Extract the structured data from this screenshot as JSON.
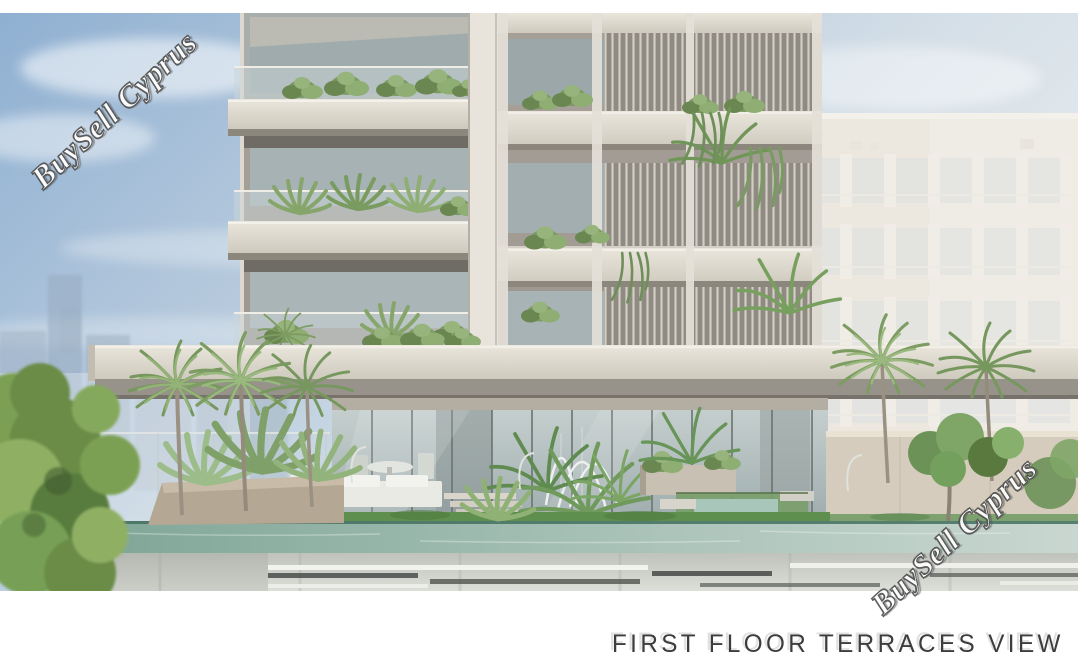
{
  "render": {
    "caption": "FIRST FLOOR TERRACES VIEW",
    "watermarks": [
      {
        "text": "BuySell Cyprus",
        "position": "top-left"
      },
      {
        "text": "BuySell Cyprus",
        "position": "bottom-right"
      }
    ],
    "colors": {
      "sky_top": "#96b4d4",
      "sky_haze": "#e9edf0",
      "concrete_light": "#dcd7cb",
      "concrete_shadow": "#8d897f",
      "glass": "#aab6b6",
      "foliage": "#7c9a62",
      "pool_water": "#8ab3a3",
      "caption_text": "#3c3c3c",
      "watermark_fill": "#fdfdfd",
      "watermark_outline": "#4f4f4f",
      "background": "#ffffff"
    }
  }
}
